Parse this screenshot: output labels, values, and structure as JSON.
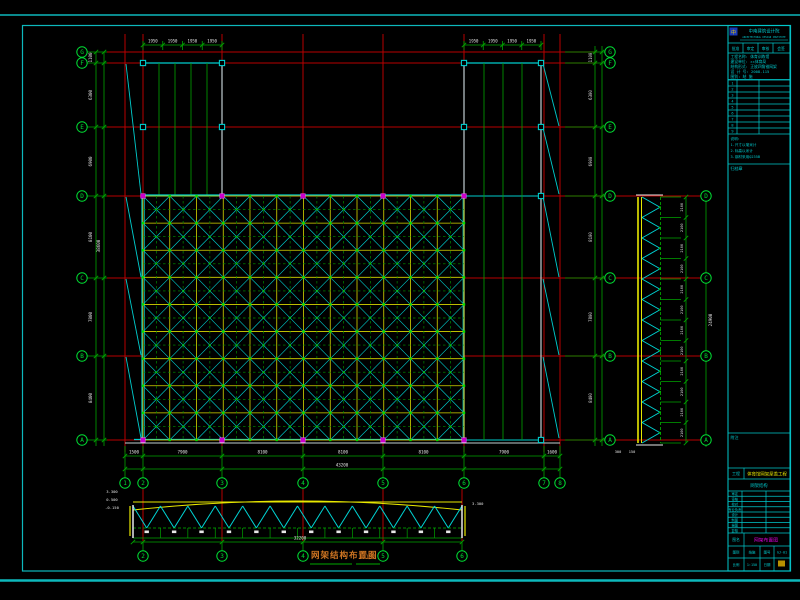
{
  "colors": {
    "background": "#000000",
    "frame_cyan": "#0db8bc",
    "axis_red": "#b80000",
    "dim_green": "#00a400",
    "bright_green": "#00dd33",
    "structure_cyan": "#00cccc",
    "chord_yellow": "#e8e800",
    "dim_text_white": "#e2e2e2",
    "support_magenta": "#cc00cc",
    "wall_gray": "#c2cfd2",
    "title_orange": "#cf7522",
    "titleblock_cyan": "#00c8cc",
    "logo_blue": "#1838b8"
  },
  "axes": {
    "numbered": [
      {
        "label": "1",
        "x": 125
      },
      {
        "label": "2",
        "x": 143
      },
      {
        "label": "3",
        "x": 222
      },
      {
        "label": "4",
        "x": 303
      },
      {
        "label": "5",
        "x": 383
      },
      {
        "label": "6",
        "x": 464
      },
      {
        "label": "7",
        "x": 544
      },
      {
        "label": "8",
        "x": 560
      }
    ],
    "lettered": [
      {
        "label": "A",
        "y": 440
      },
      {
        "label": "B",
        "y": 356
      },
      {
        "label": "C",
        "y": 278
      },
      {
        "label": "D",
        "y": 196
      },
      {
        "label": "E",
        "y": 127
      },
      {
        "label": "F",
        "y": 63
      },
      {
        "label": "G",
        "y": 52
      }
    ]
  },
  "dimensions": {
    "bottom_bays": [
      "1500",
      "7900",
      "8100",
      "8100",
      "8100",
      "7900",
      "1600"
    ],
    "bottom_total": "43200",
    "left_rows": [
      "1100",
      "6300",
      "6900",
      "8100",
      "7800",
      "8400"
    ],
    "left_total": "38600",
    "wing_bays": [
      "1950",
      "1950",
      "1950",
      "1950"
    ],
    "right_truss_panel": "2100",
    "right_truss_total": "24900",
    "right_truss_base": [
      "300",
      "150"
    ],
    "bottom_truss_total": "32200",
    "bottom_truss_levels": [
      "3.300",
      "0.500",
      "-0.150"
    ]
  },
  "main_title": {
    "text": "网架结构布置图",
    "scale": "1:150"
  },
  "elevation_bottom": {
    "axis_labels": [
      "2",
      "3",
      "4",
      "5",
      "6"
    ]
  },
  "title_block": {
    "logo_glyph": "中",
    "institute_line1": "中南建筑设计院",
    "institute_line2": "ARCHITECTURAL DESIGN INSTITUTE",
    "approval_cells": [
      "批准",
      "审定",
      "审核",
      "会签"
    ],
    "info_lines": [
      "工程名称: 体育训练馆",
      "建设单位: ××体育局",
      "结构形式: 正放四角锥网架",
      "设 计 号: 2008-115",
      "图别: 结 施"
    ],
    "revision_rows": [
      [
        "1"
      ],
      [
        "2"
      ],
      [
        "3"
      ],
      [
        "4"
      ],
      [
        "5"
      ],
      [
        "6"
      ],
      [
        "7"
      ],
      [
        "8"
      ],
      [
        "9"
      ]
    ],
    "note_lines": [
      "说明:",
      "1.尺寸以毫米计",
      "2.标高以米计",
      "3.钢材采用Q235B"
    ],
    "archive_note": "归档章",
    "attachment_note": "附注",
    "project_label": "工程",
    "project_name": "体育馆网架屋盖工程",
    "subproject": "网架结构",
    "sign_rows": [
      [
        "审定"
      ],
      [
        "审核"
      ],
      [
        "校对"
      ],
      [
        "专业负责"
      ],
      [
        "设计"
      ],
      [
        "制图"
      ],
      [
        "描图"
      ],
      [
        "复核"
      ]
    ],
    "drawing_title_label": "图名",
    "drawing_title": "网架布置图",
    "bottom_row1": [
      "图别",
      "结施",
      "图号",
      "GJ-01"
    ],
    "bottom_row2": [
      "比例",
      "1:150",
      "日期"
    ]
  }
}
